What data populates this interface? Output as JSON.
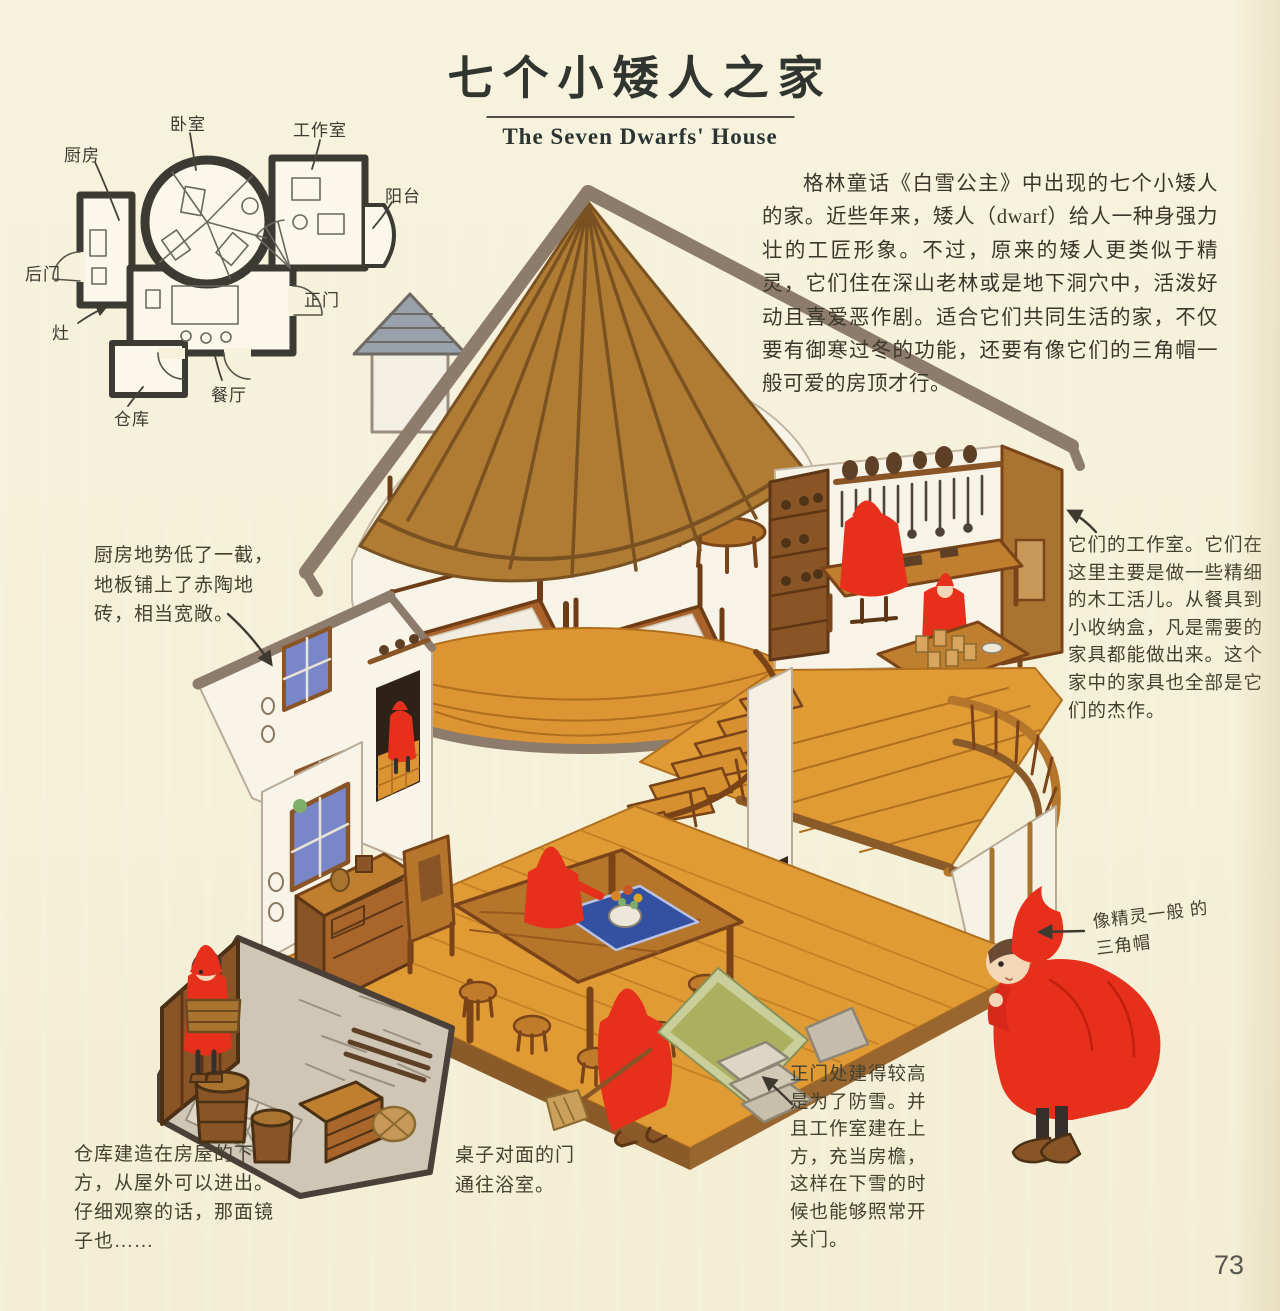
{
  "page": {
    "page_number": "73",
    "background_color": "#f6f1da"
  },
  "header": {
    "title_zh": "七个小矮人之家",
    "title_en": "The Seven Dwarfs' House"
  },
  "intro": {
    "text": "格林童话《白雪公主》中出现的七个小矮人的家。近些年来，矮人（dwarf）给人一种身强力壮的工匠形象。不过，原来的矮人更类似于精灵，它们住在深山老林或是地下洞穴中，活泼好动且喜爱恶作剧。适合它们共同生活的家，不仅要有御寒过冬的功能，还要有像它们的三角帽一般可爱的房顶才行。"
  },
  "floor_plan": {
    "labels": {
      "kitchen": "厨房",
      "bedroom": "卧室",
      "workshop": "工作室",
      "balcony": "阳台",
      "back_door": "后门",
      "stove": "灶",
      "front_door": "正门",
      "dining": "餐厅",
      "storage": "仓库"
    }
  },
  "annotations": {
    "kitchen": "厨房地势低了一截，地板铺上了赤陶地砖，相当宽敞。",
    "workshop": "它们的工作室。它们在这里主要是做一些精细的木工活儿。从餐具到小收纳盒，凡是需要的家具都能做出来。这个家中的家具也全部是它们的杰作。",
    "hat": "像精灵一般 的三角帽",
    "front_door": "正门处建得较高是为了防雪。并且工作室建在上方，充当房檐，这样在下雪的时候也能够照常开关门。",
    "bathroom": "桌子对面的门通往浴室。",
    "storage": "仓库建造在房屋的下方，从屋外可以进出。仔细观察的话，那面镜子也……"
  },
  "palette": {
    "page_bg": "#f6f1da",
    "roof_brown": "#b07c33",
    "roof_rib": "#7a5222",
    "roof_trim_gray": "#8d7b6b",
    "wall_cream": "#f7f3e6",
    "floor_orange": "#e09b35",
    "floor_line": "#b06f1e",
    "wood_mid": "#b5762b",
    "wood_dark": "#7a4418",
    "dwarf_red": "#e6301b",
    "window_blue": "#7986c8",
    "cloth_blue": "#3450a0",
    "mat_green": "#abb05e",
    "stone_gray": "#cfc6b5",
    "ink": "#3f3a31"
  }
}
